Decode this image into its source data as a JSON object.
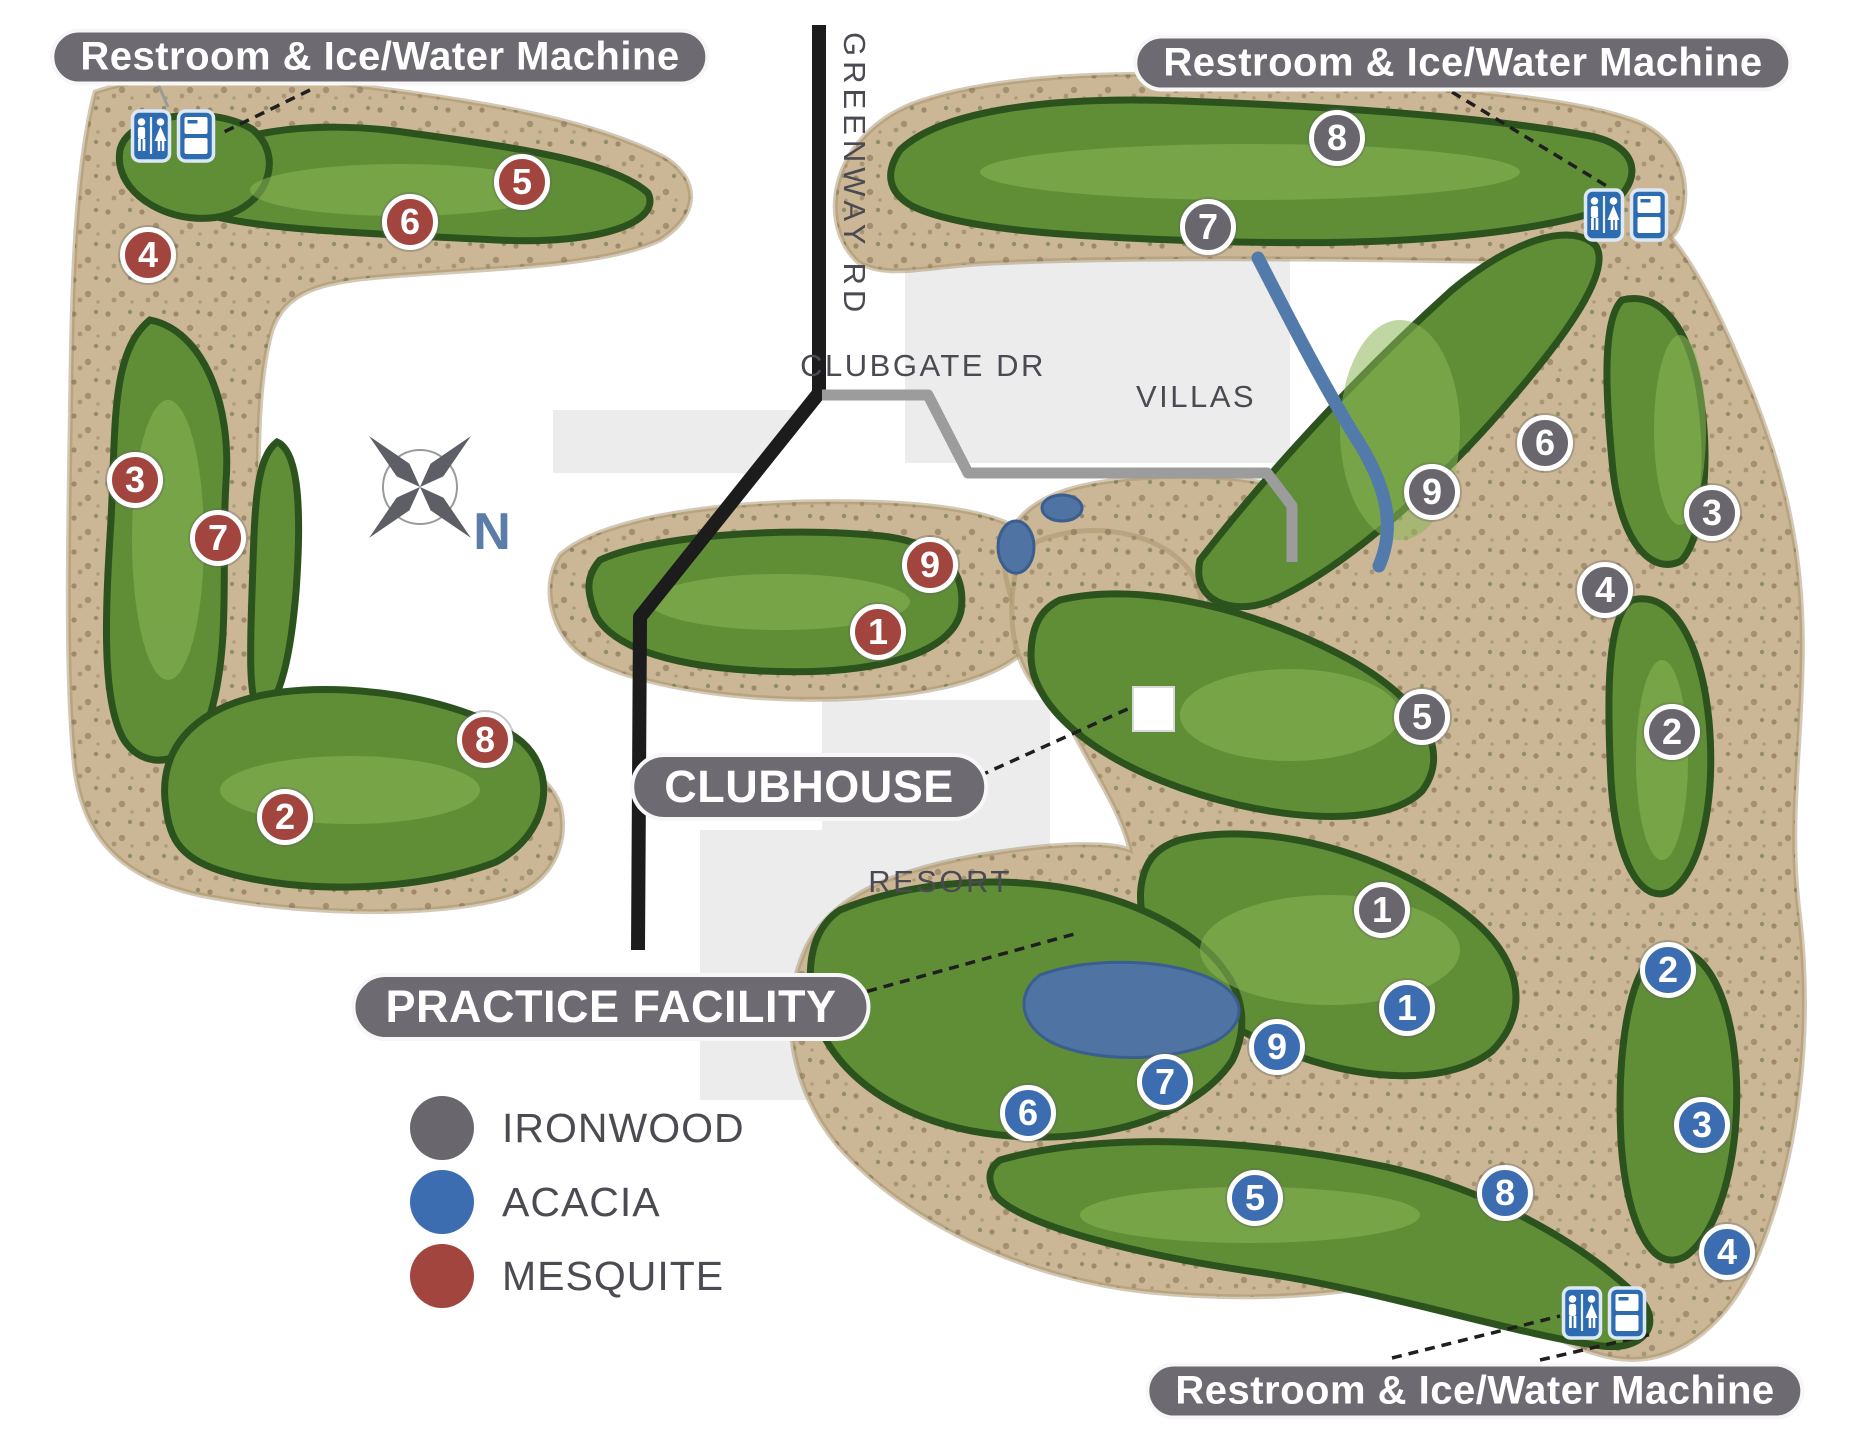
{
  "map": {
    "facility_labels": {
      "restroom_ice_water": "Restroom & Ice/Water Machine",
      "clubhouse": "CLUBHOUSE",
      "practice_facility": "PRACTICE FACILITY"
    },
    "roads": {
      "greenway": "GREENWAY RD",
      "clubgate": "CLUBGATE DR"
    },
    "areas": {
      "villas": "VILLAS",
      "resort": "RESORT"
    },
    "compass": {
      "label": "N"
    },
    "courses": [
      {
        "id": "ironwood",
        "name": "IRONWOOD",
        "color": "#69676d"
      },
      {
        "id": "acacia",
        "name": "ACACIA",
        "color": "#3d6db1"
      },
      {
        "id": "mesquite",
        "name": "MESQUITE",
        "color": "#a2453e"
      }
    ],
    "markers": [
      {
        "course": "mesquite",
        "number": "1",
        "x": 878,
        "y": 632
      },
      {
        "course": "mesquite",
        "number": "2",
        "x": 285,
        "y": 817
      },
      {
        "course": "mesquite",
        "number": "3",
        "x": 135,
        "y": 480
      },
      {
        "course": "mesquite",
        "number": "4",
        "x": 148,
        "y": 255
      },
      {
        "course": "mesquite",
        "number": "5",
        "x": 522,
        "y": 182
      },
      {
        "course": "mesquite",
        "number": "6",
        "x": 410,
        "y": 222
      },
      {
        "course": "mesquite",
        "number": "7",
        "x": 218,
        "y": 538
      },
      {
        "course": "mesquite",
        "number": "8",
        "x": 485,
        "y": 740
      },
      {
        "course": "mesquite",
        "number": "9",
        "x": 930,
        "y": 565
      },
      {
        "course": "ironwood",
        "number": "1",
        "x": 1382,
        "y": 910
      },
      {
        "course": "ironwood",
        "number": "2",
        "x": 1672,
        "y": 732
      },
      {
        "course": "ironwood",
        "number": "3",
        "x": 1712,
        "y": 513
      },
      {
        "course": "ironwood",
        "number": "4",
        "x": 1605,
        "y": 590
      },
      {
        "course": "ironwood",
        "number": "5",
        "x": 1422,
        "y": 717
      },
      {
        "course": "ironwood",
        "number": "6",
        "x": 1545,
        "y": 443
      },
      {
        "course": "ironwood",
        "number": "7",
        "x": 1208,
        "y": 227
      },
      {
        "course": "ironwood",
        "number": "8",
        "x": 1337,
        "y": 138
      },
      {
        "course": "ironwood",
        "number": "9",
        "x": 1432,
        "y": 492
      },
      {
        "course": "acacia",
        "number": "1",
        "x": 1407,
        "y": 1008
      },
      {
        "course": "acacia",
        "number": "2",
        "x": 1668,
        "y": 970
      },
      {
        "course": "acacia",
        "number": "3",
        "x": 1702,
        "y": 1125
      },
      {
        "course": "acacia",
        "number": "4",
        "x": 1727,
        "y": 1252
      },
      {
        "course": "acacia",
        "number": "5",
        "x": 1255,
        "y": 1198
      },
      {
        "course": "acacia",
        "number": "6",
        "x": 1028,
        "y": 1113
      },
      {
        "course": "acacia",
        "number": "7",
        "x": 1165,
        "y": 1082
      },
      {
        "course": "acacia",
        "number": "8",
        "x": 1505,
        "y": 1193
      },
      {
        "course": "acacia",
        "number": "9",
        "x": 1277,
        "y": 1047
      }
    ],
    "restroom_stations": [
      {
        "x": 173,
        "y": 136
      },
      {
        "x": 1626,
        "y": 215
      },
      {
        "x": 1604,
        "y": 1313
      }
    ]
  }
}
